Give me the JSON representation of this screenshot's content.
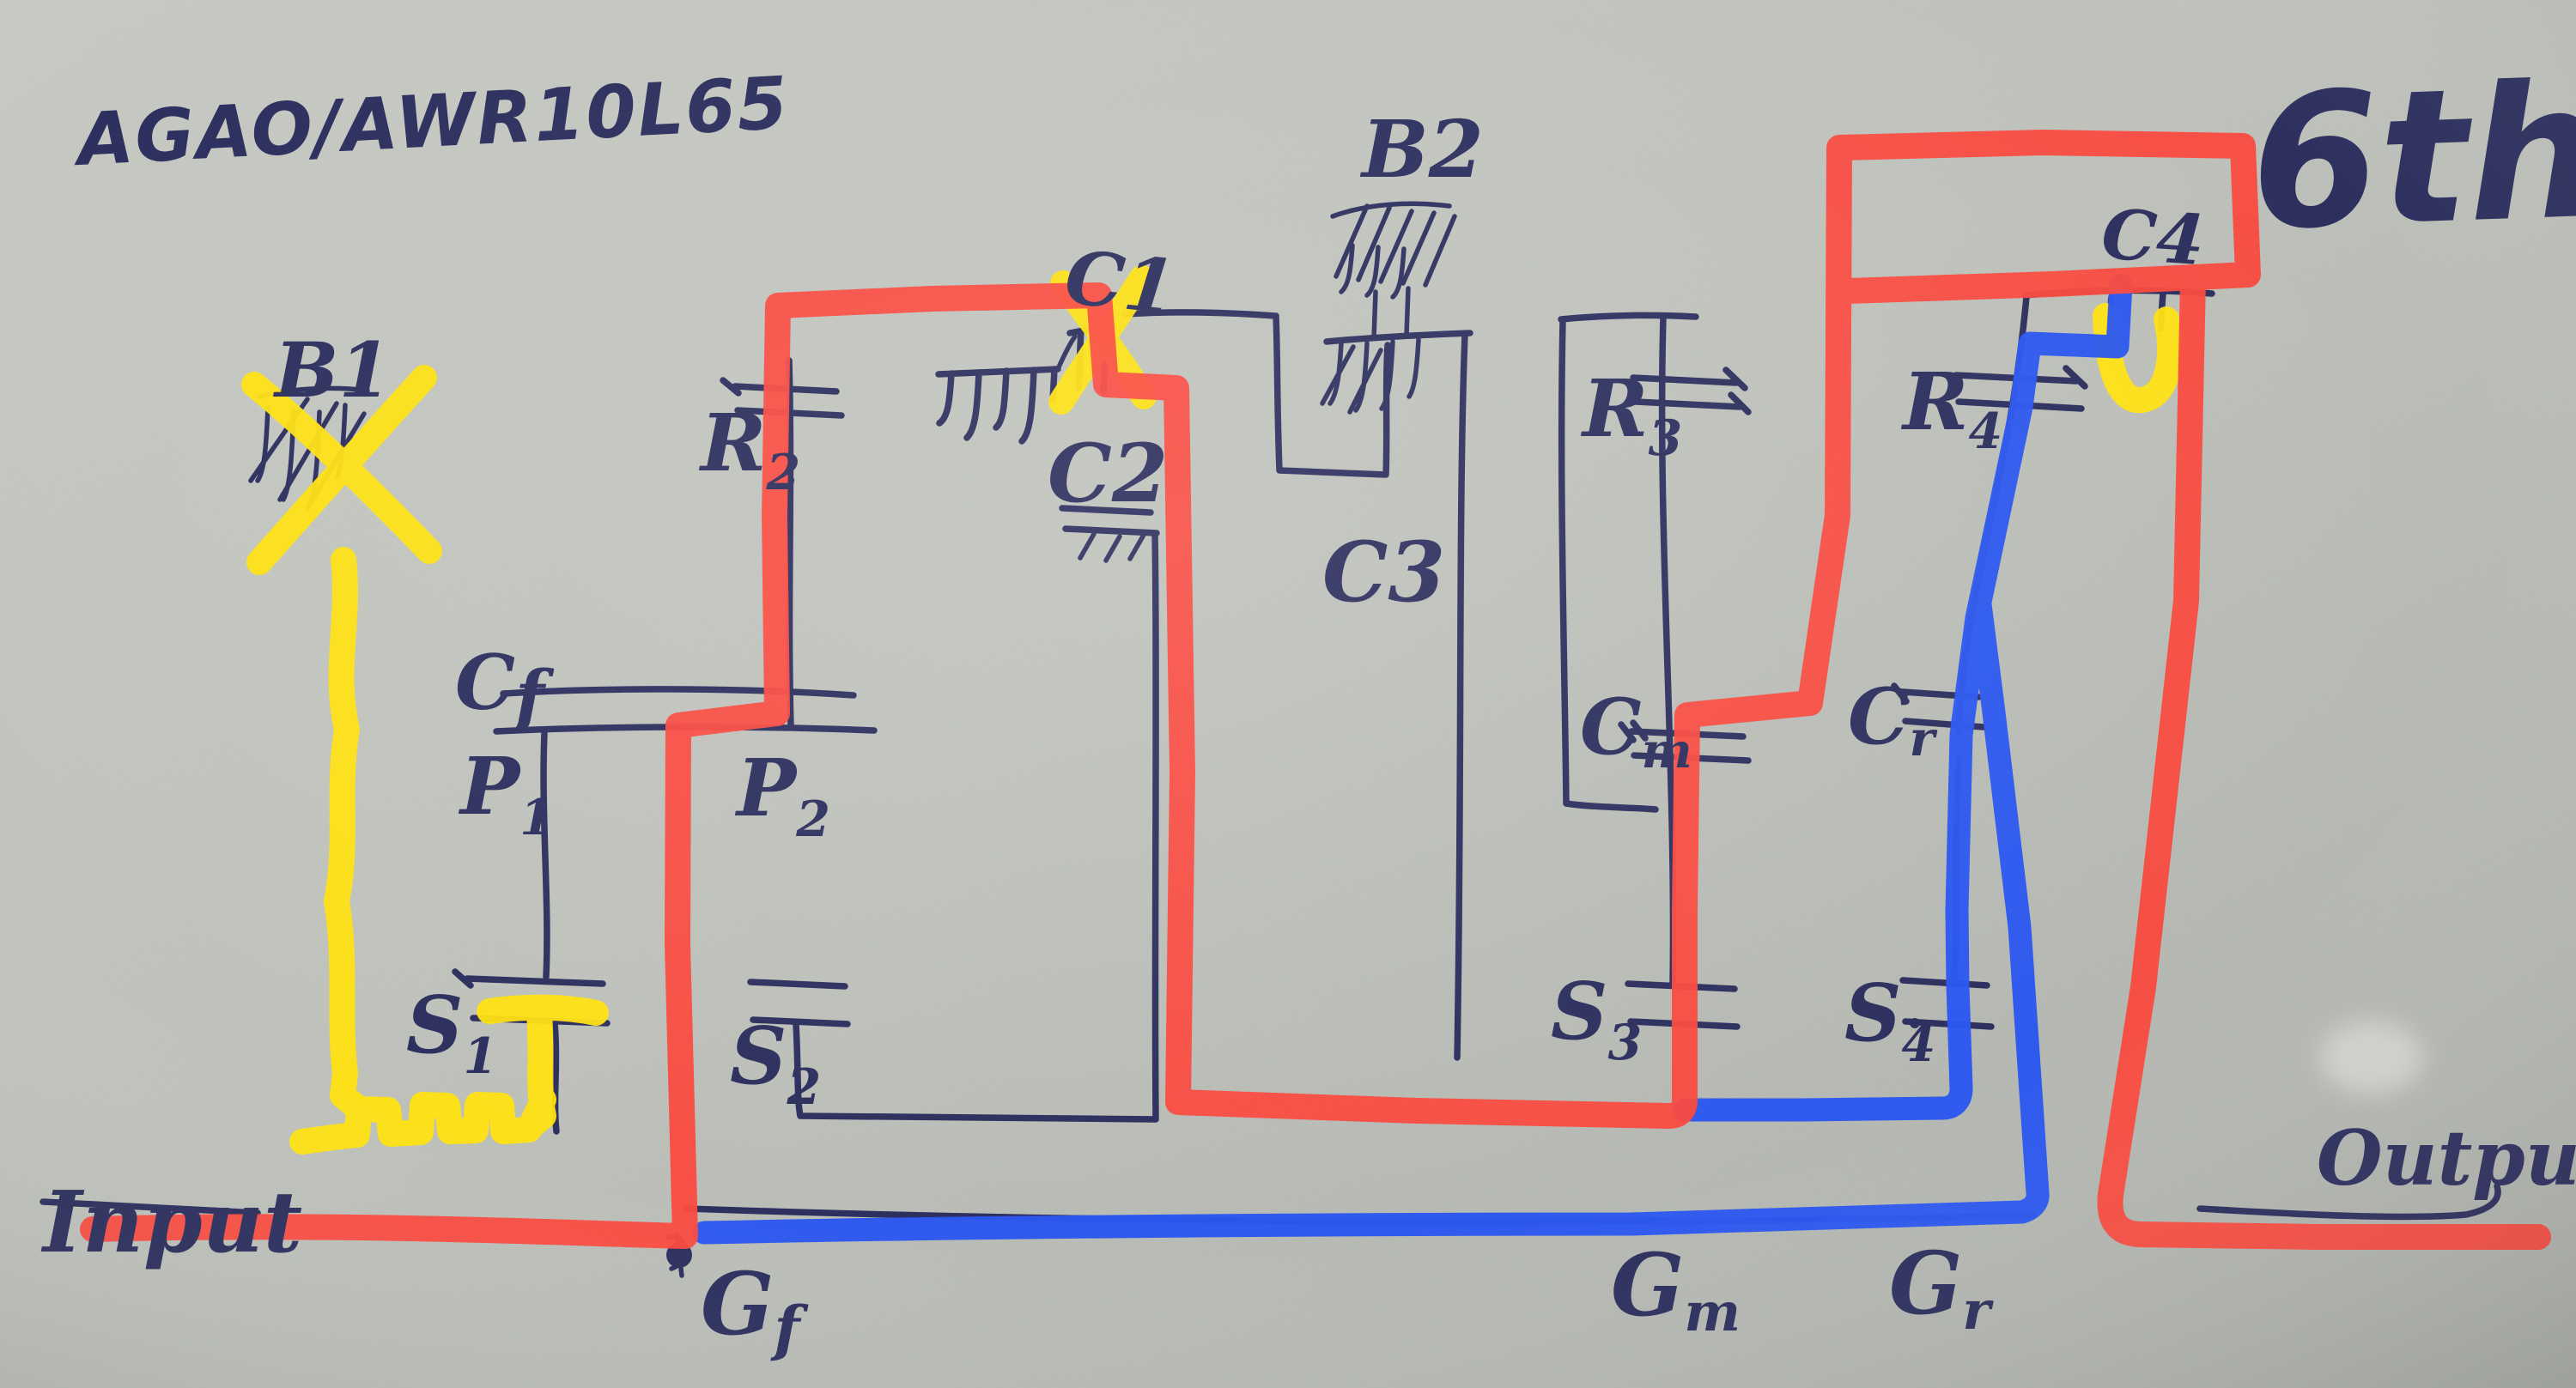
{
  "photo": {
    "title": "AGAO/AWR10L65",
    "order_note": "6th",
    "description": "hand-drawn 6th order filter sketch with red, blue and yellow marker routes"
  },
  "io": {
    "input": "Input",
    "output": "Output"
  },
  "labels": {
    "b1": {
      "main": "B1"
    },
    "b2": {
      "main": "B2"
    },
    "c1": {
      "main": "C1"
    },
    "c2": {
      "main": "C2"
    },
    "c3": {
      "main": "C3"
    },
    "c4": {
      "main": "C4"
    },
    "r2": {
      "main": "R",
      "sub": "2"
    },
    "r3": {
      "main": "R",
      "sub": "3"
    },
    "r4": {
      "main": "R",
      "sub": "4"
    },
    "cf": {
      "main": "C",
      "sub": "f"
    },
    "cm": {
      "main": "C",
      "sub": "m"
    },
    "cr": {
      "main": "C",
      "sub": "r"
    },
    "p1": {
      "main": "P",
      "sub": "1"
    },
    "p2": {
      "main": "P",
      "sub": "2"
    },
    "s1": {
      "main": "S",
      "sub": "1"
    },
    "s2": {
      "main": "S",
      "sub": "2"
    },
    "s3": {
      "main": "S",
      "sub": "3"
    },
    "s4": {
      "main": "S",
      "sub": "4"
    },
    "gf": {
      "main": "G",
      "sub": "f"
    },
    "gm": {
      "main": "G",
      "sub": "m"
    },
    "gr": {
      "main": "G",
      "sub": "r"
    }
  },
  "colors": {
    "paper": "#bfc2bb",
    "ink": "#2d2f5e",
    "red": "#fa4a3f",
    "yellow": "#ffe212",
    "blue": "#2b57f0"
  }
}
